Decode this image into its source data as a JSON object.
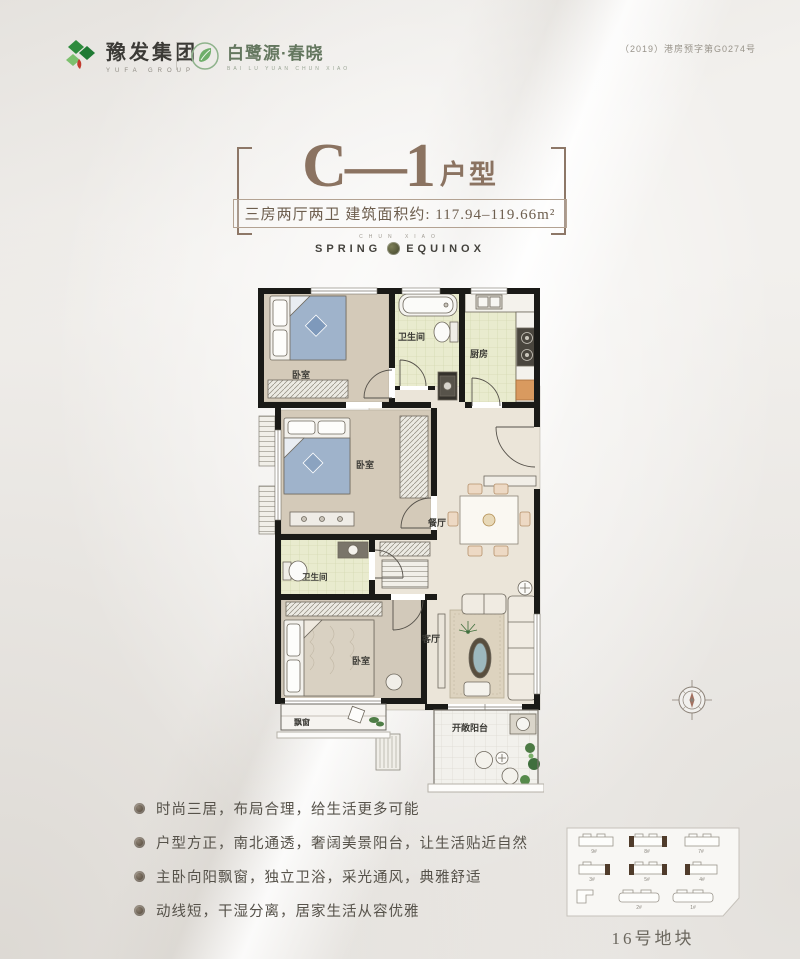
{
  "header": {
    "group_logo": {
      "name": "豫发集团",
      "sub": "YUFA GROUP"
    },
    "project_logo": {
      "name": "白鹭源·春晓",
      "sub": "BAI LU YUAN CHUN XIAO"
    },
    "permit": "（2019）港房预字第G0274号"
  },
  "title_block": {
    "unit": "C—1",
    "suffix": "户型",
    "subtitle": "三房两厅两卫 建筑面积约: 117.94–119.66m²"
  },
  "emblem": {
    "micro": "CHUN XIAO",
    "left": "SPRING",
    "right": "EQUINOX"
  },
  "floorplan": {
    "labels": {
      "bedroom1": "卧室",
      "bath1": "卫生间",
      "kitchen": "厨房",
      "bedroom2": "卧室",
      "bath2": "卫生间",
      "dining": "餐厅",
      "living": "客厅",
      "bedroom3": "卧室",
      "bay_window": "飘窗",
      "balcony": "开敞阳台"
    },
    "colors": {
      "wall": "#1a1a17",
      "wood": "#d4cab9",
      "tile": "#e9ebce",
      "hall": "#ebe5d9"
    }
  },
  "features": {
    "items": [
      "时尚三居，布局合理，给生活更多可能",
      "户型方正，南北通透，奢阔美景阳台，让生活贴近自然",
      "主卧向阳飘窗，独立卫浴，采光通风，典雅舒适",
      "动线短，干湿分离，居家生活从容优雅"
    ]
  },
  "siteplan": {
    "caption": "16号地块",
    "buildings": [
      "9#",
      "8#",
      "7#",
      "3#",
      "5#",
      "4#",
      "2#",
      "1#"
    ]
  }
}
